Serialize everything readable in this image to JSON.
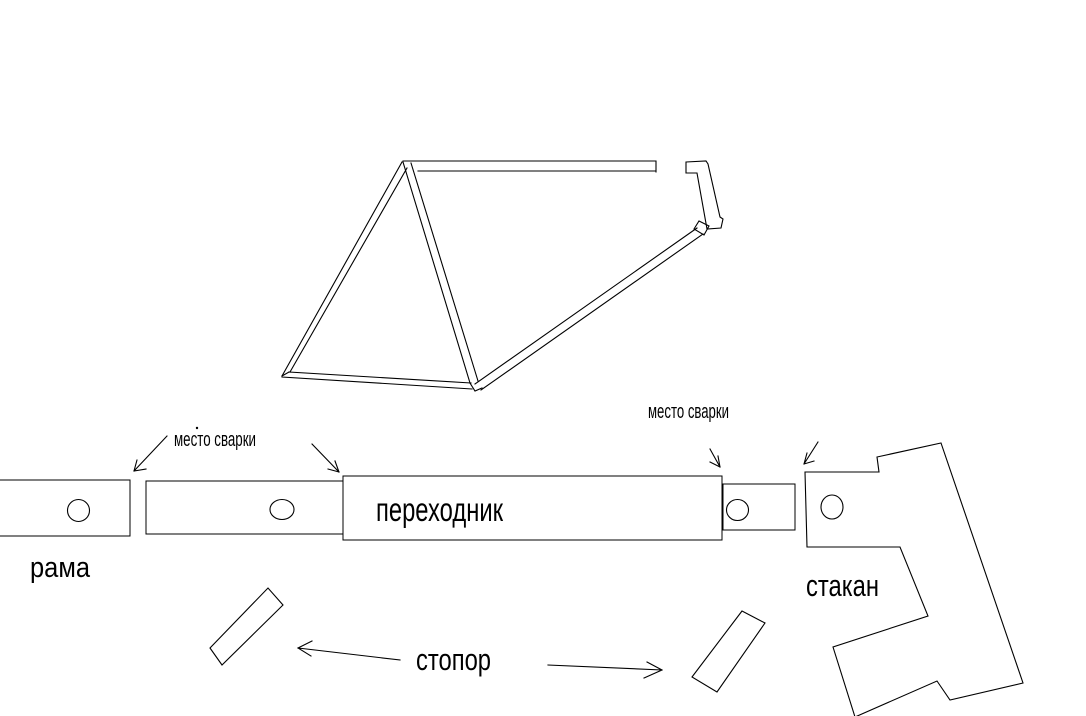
{
  "colors": {
    "background": "#ffffff",
    "ink": "#000000"
  },
  "labels": {
    "weld_site": "место сварки",
    "frame": "рама",
    "adapter": "переходник",
    "cup": "стакан",
    "stopper": "стопор"
  }
}
